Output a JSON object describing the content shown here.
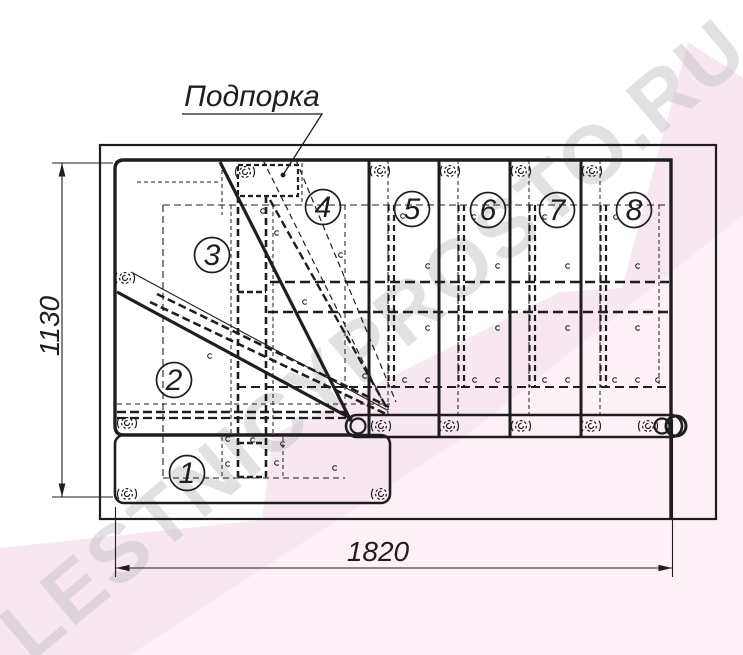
{
  "callout": {
    "label": "Подпорка"
  },
  "dimensions": {
    "height_mm": "1130",
    "width_mm": "1820"
  },
  "steps": [
    "1",
    "2",
    "3",
    "4",
    "5",
    "6",
    "7",
    "8"
  ],
  "watermark": {
    "text": "LESTNICYPROSTO.RU"
  },
  "colors": {
    "ink": "#1e1e1e",
    "pink": "#f7e7f1",
    "pink_light": "#fbf2f7",
    "watermark": "#c7c3c6"
  }
}
